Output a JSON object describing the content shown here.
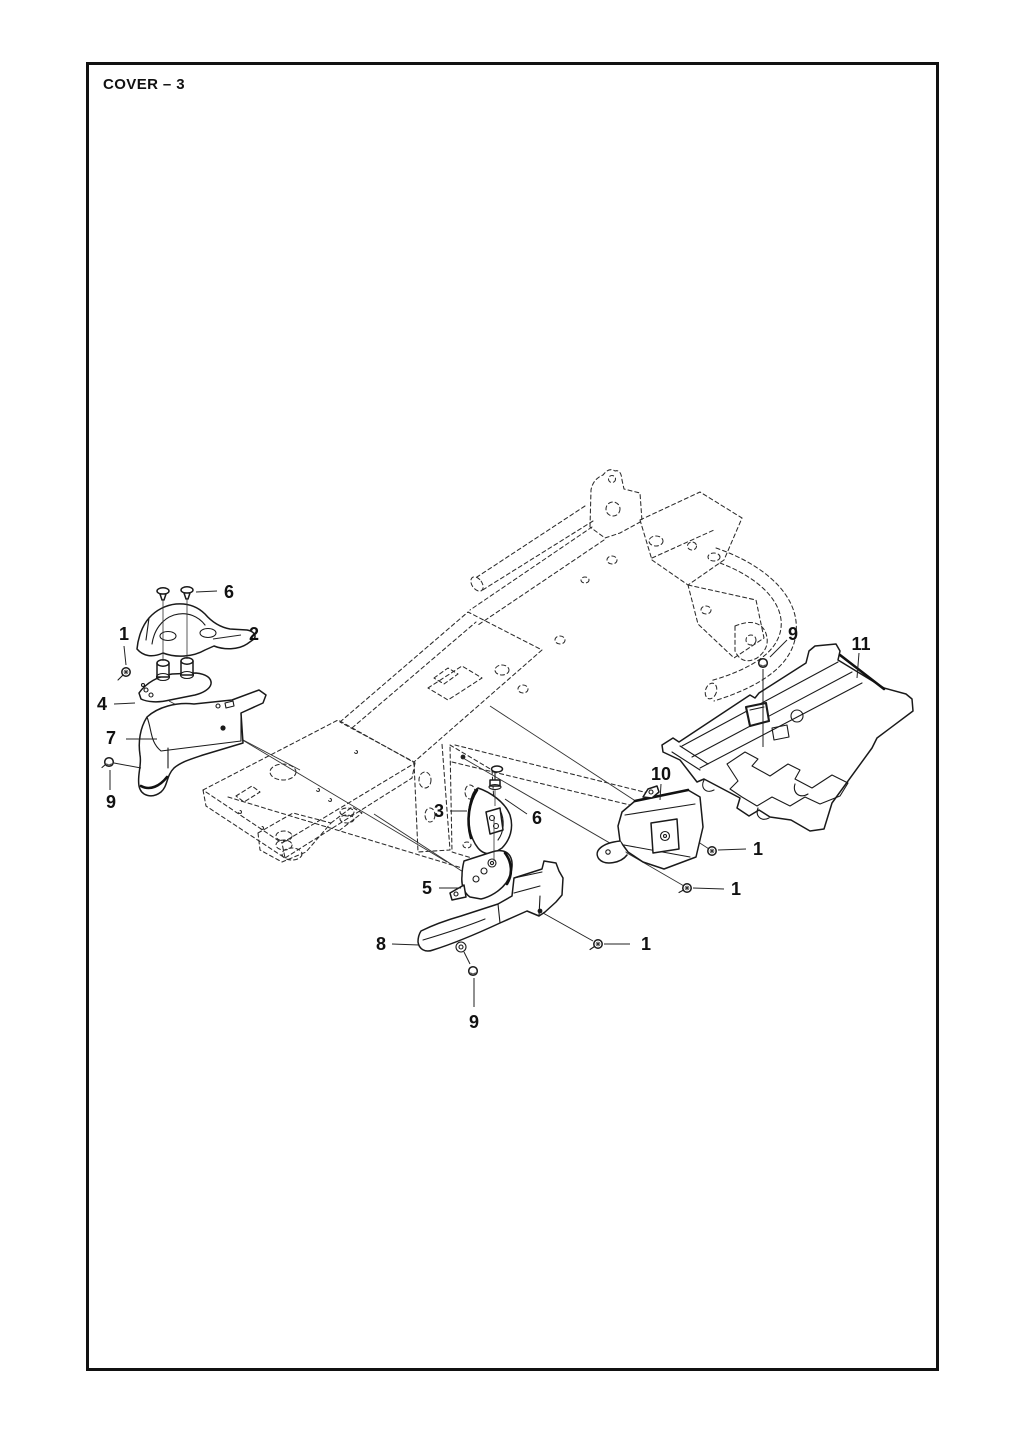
{
  "page": {
    "title": "COVER – 3"
  },
  "figure": {
    "type": "exploded-parts-diagram",
    "subject": "cover assembly on chassis frame (phantom view)",
    "callouts": [
      {
        "label": "6"
      },
      {
        "label": "2"
      },
      {
        "label": "1"
      },
      {
        "label": "4"
      },
      {
        "label": "7"
      },
      {
        "label": "9"
      },
      {
        "label": "3"
      },
      {
        "label": "6"
      },
      {
        "label": "5"
      },
      {
        "label": "8"
      },
      {
        "label": "1"
      },
      {
        "label": "9"
      },
      {
        "label": "10"
      },
      {
        "label": "1"
      },
      {
        "label": "1"
      },
      {
        "label": "9"
      },
      {
        "label": "11"
      }
    ]
  }
}
